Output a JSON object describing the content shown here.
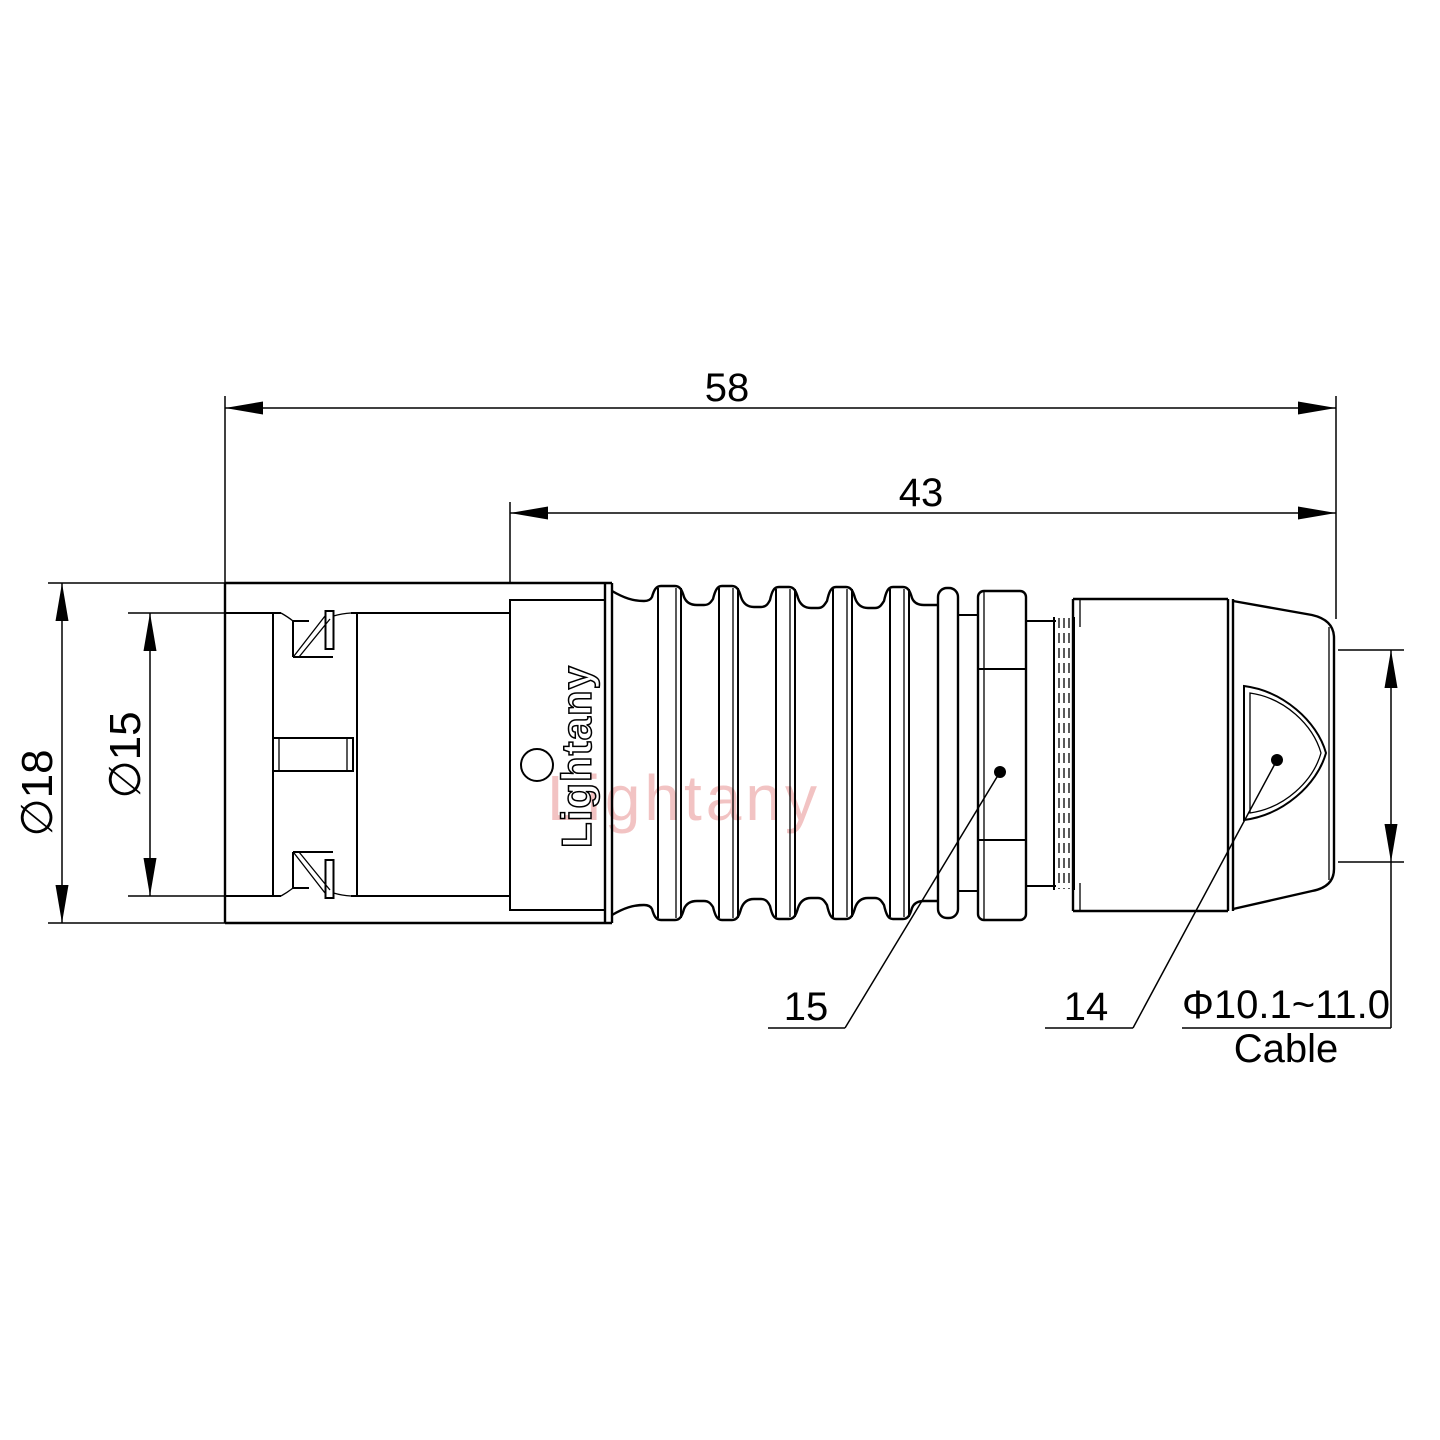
{
  "brand": {
    "panel_text": "Lightany",
    "watermark": "Lightany"
  },
  "dimensions": {
    "overall_length": "58",
    "rear_length": "43",
    "outer_diameter": "∅18",
    "inner_diameter": "∅15",
    "cable_range": "Φ10.1~11.0",
    "cable_label": "Cable"
  },
  "callouts": {
    "gland_nut": "15",
    "backshell": "14"
  },
  "colors": {
    "line": "#000000",
    "background": "#ffffff",
    "watermark": "#f0b9b9"
  }
}
